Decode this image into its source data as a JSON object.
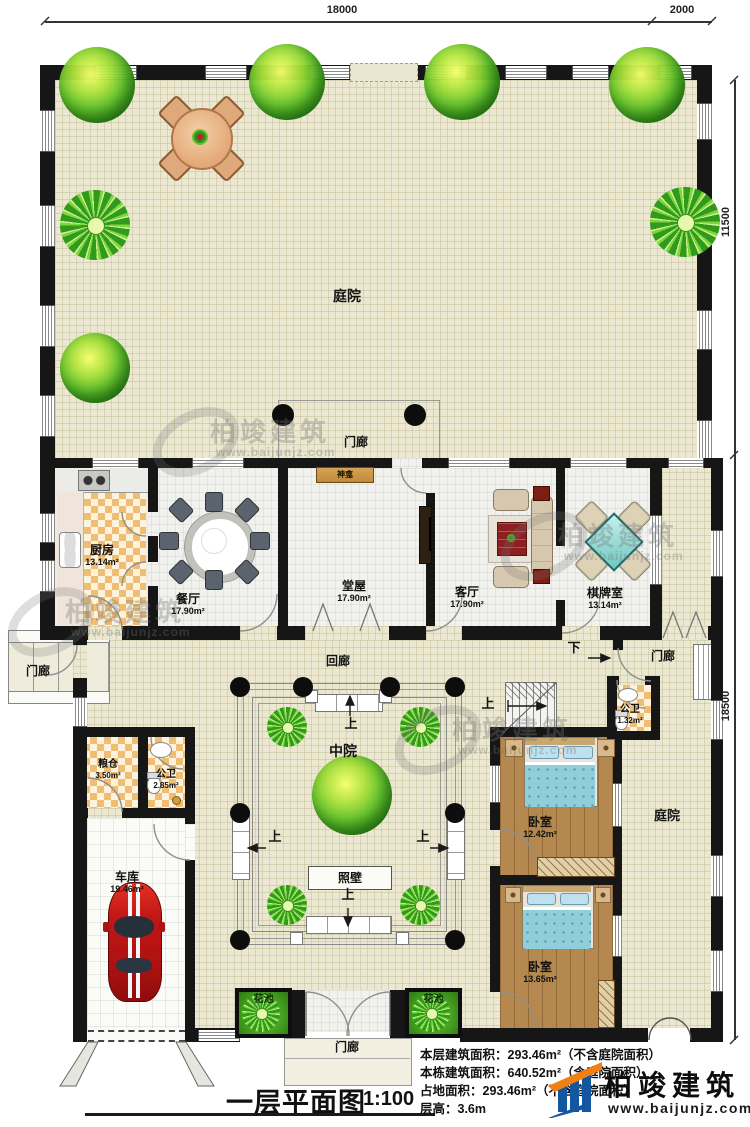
{
  "canvas": {
    "width": 750,
    "height": 1127
  },
  "dimensions": {
    "top_width": "18000",
    "top_right_width": "2000",
    "right_upper_height": "11500",
    "right_lower_height": "18500"
  },
  "rooms": {
    "courtyard_top": {
      "name": "庭院"
    },
    "porch_top": {
      "name": "门廊"
    },
    "kitchen": {
      "name": "厨房",
      "area": "13.14m²"
    },
    "dining": {
      "name": "餐厅",
      "area": "17.90m²"
    },
    "hall": {
      "name": "堂屋",
      "area": "17.90m²"
    },
    "shrine": {
      "name": "神龛"
    },
    "living": {
      "name": "客厅",
      "area": "17.90m²"
    },
    "mahjong_room": {
      "name": "棋牌室",
      "area": "13.14m²"
    },
    "porch_left": {
      "name": "门廊"
    },
    "cloister": {
      "name": "回廊"
    },
    "middle_court": {
      "name": "中院"
    },
    "screen_wall": {
      "name": "照壁"
    },
    "granary": {
      "name": "粮仓",
      "area": "3.50m²"
    },
    "bath_left": {
      "name": "公卫",
      "area": "2.85m²"
    },
    "garage": {
      "name": "车库",
      "area": "19.46m²"
    },
    "porch_right": {
      "name": "门廊"
    },
    "bath_right": {
      "name": "公卫",
      "area": "1.32m²"
    },
    "bedroom_upper": {
      "name": "卧室",
      "area": "12.42m²"
    },
    "bedroom_lower": {
      "name": "卧室",
      "area": "13.65m²"
    },
    "courtyard_right": {
      "name": "庭院"
    },
    "flower_bed_left": {
      "name": "花池"
    },
    "flower_bed_right": {
      "name": "花池"
    },
    "porch_bottom": {
      "name": "门廊"
    }
  },
  "stairs": {
    "up": "上",
    "down": "下"
  },
  "title": {
    "name": "一层平面图",
    "scale": "1:100"
  },
  "stats": {
    "line1": "本层建筑面积：293.46m²（不含庭院面积）",
    "line2": "本栋建筑面积：640.52m²（含庭院面积）",
    "line3": "占地面积：293.46m²（不含庭院面积）",
    "line4": "层高：3.6m"
  },
  "brand": {
    "name": "柏竣建筑",
    "site": "www.baijunjz.com"
  },
  "colors": {
    "wall": "#161616",
    "courtyard": "#ebe7d0",
    "checker": "#efbe74",
    "wood_floor": "#b4884e",
    "bed": "#8ecfdb",
    "mahjong_table": "#7fd0ca",
    "logo_blue": "#1456a0",
    "logo_orange": "#f08013",
    "tree": "#37941f",
    "car": "#c01616"
  }
}
